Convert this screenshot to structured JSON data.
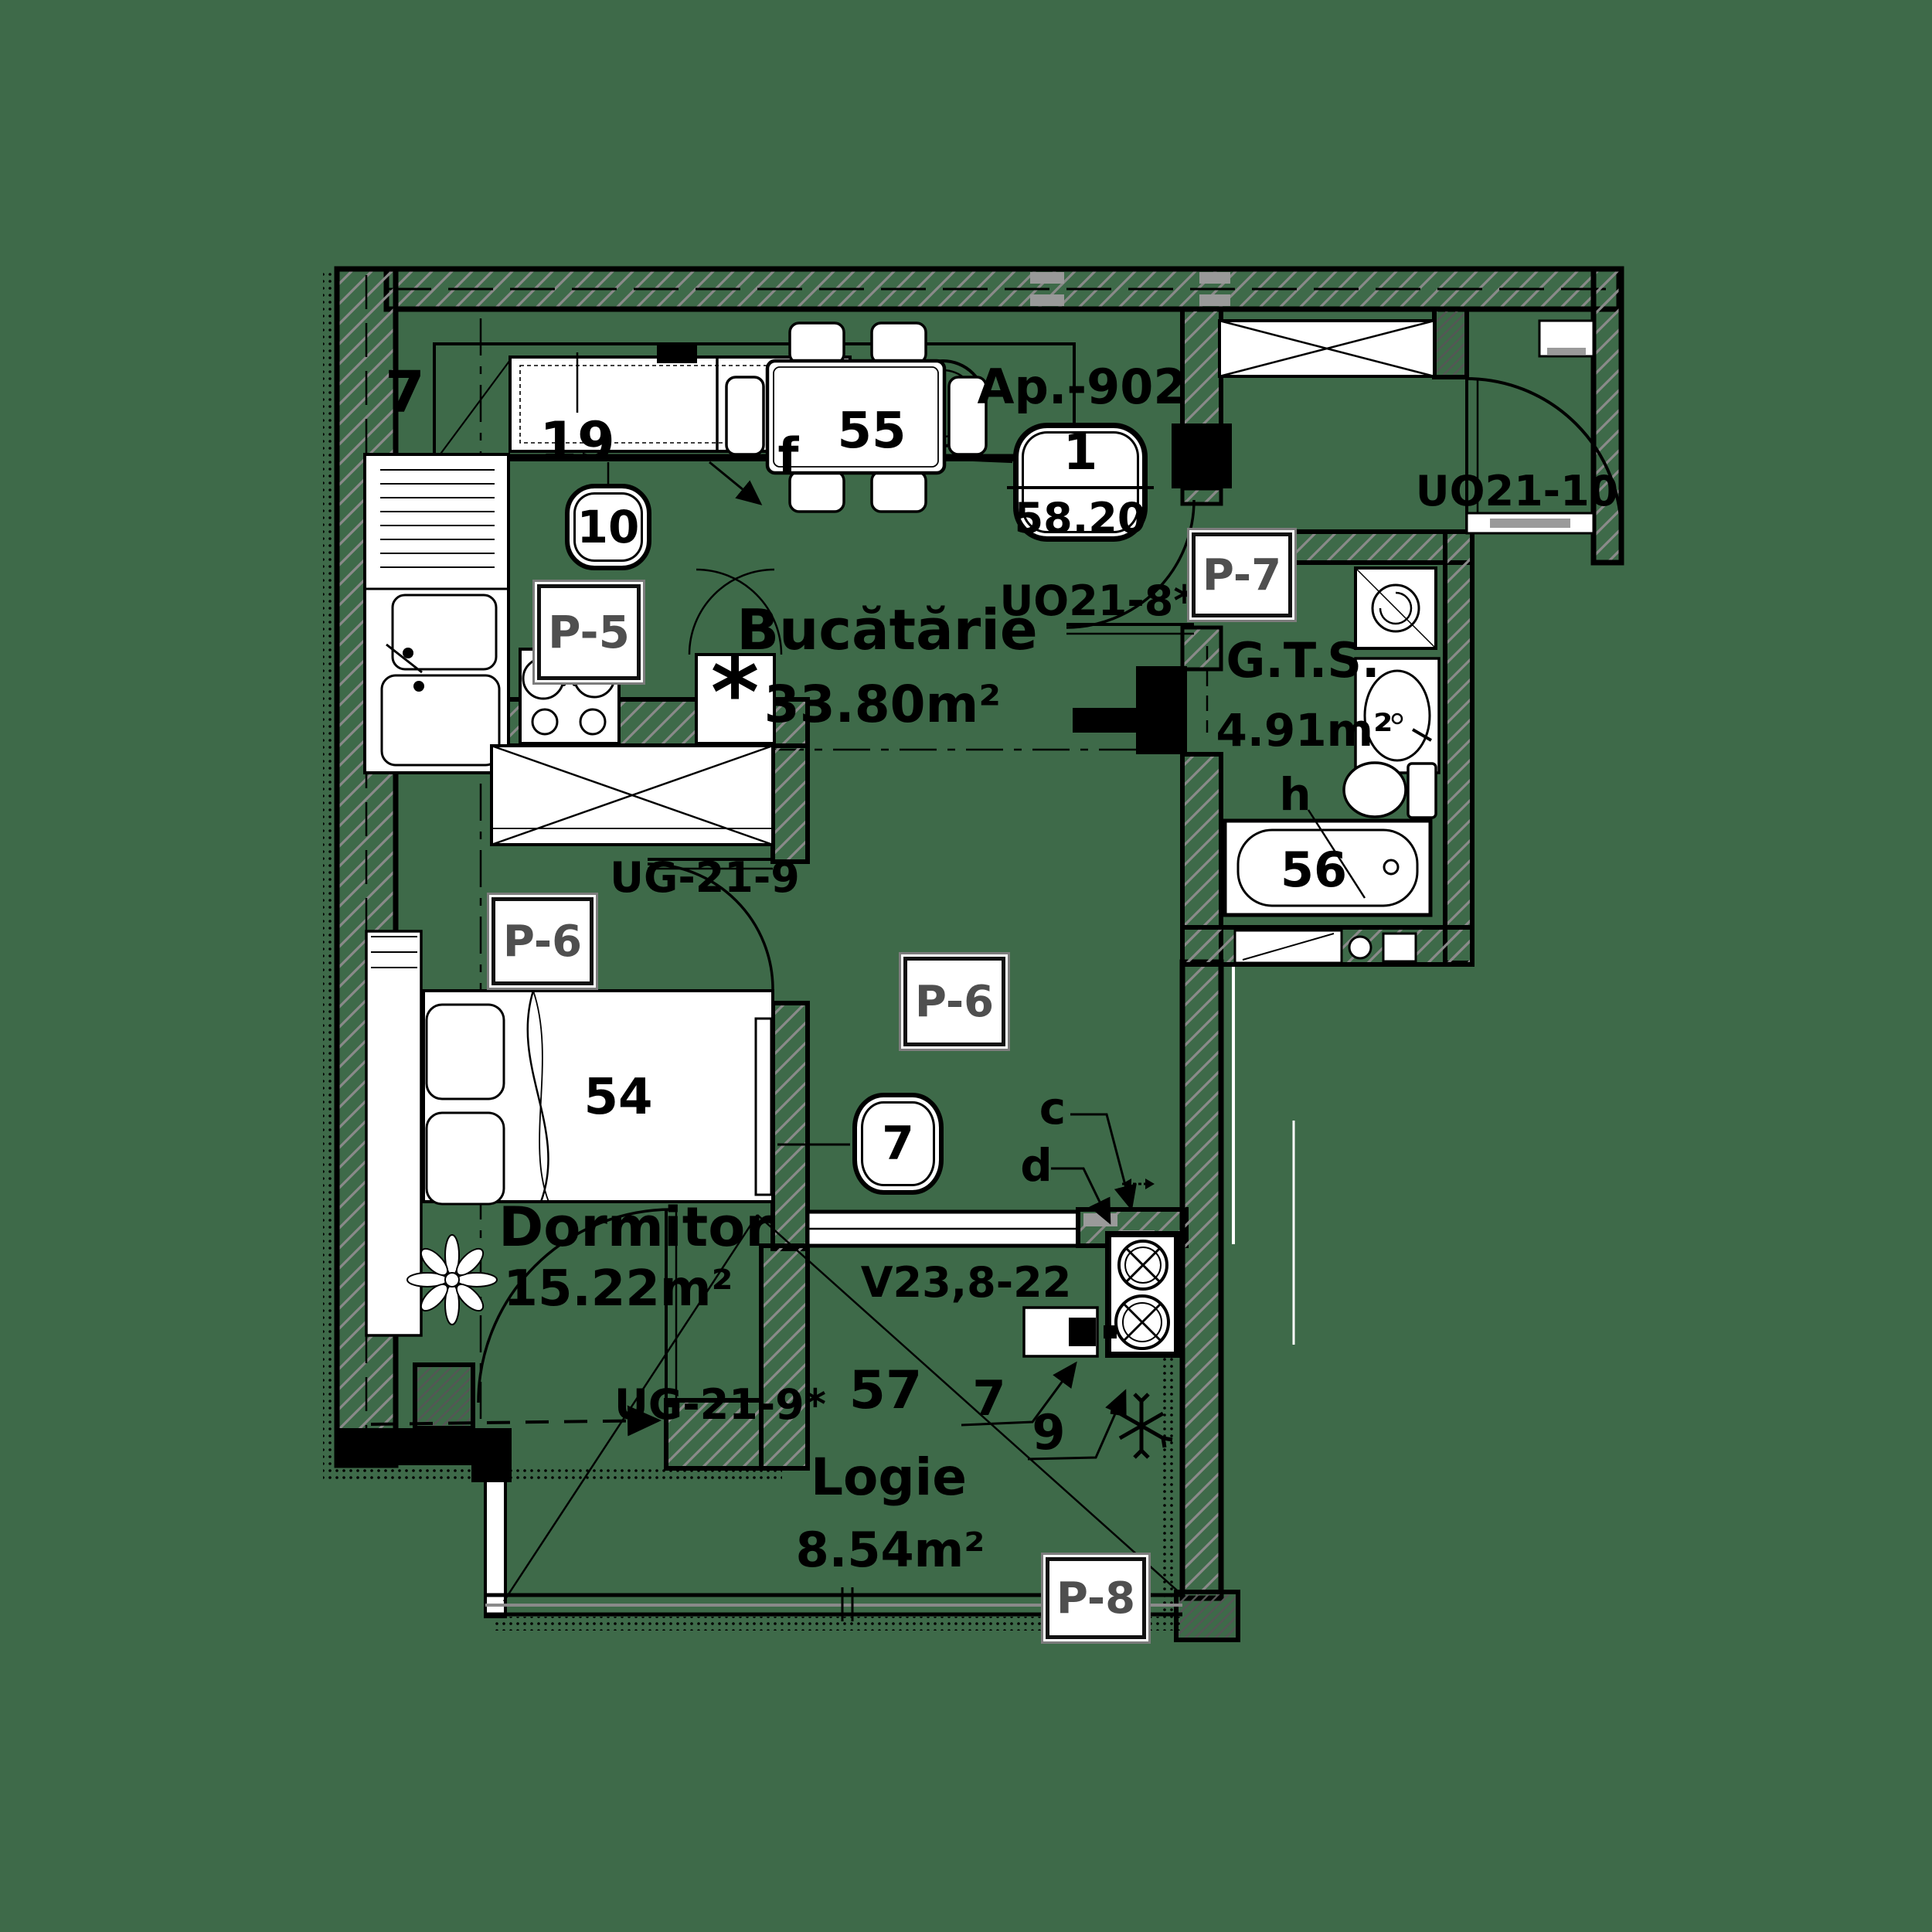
{
  "colors": {
    "background": "#3E6A49",
    "ink": "#000000",
    "paper": "#FFFFFF",
    "wall_hatch": "#8A8A8A",
    "muted_text": "#4F4F4F",
    "sill_gray": "#9A9A9A"
  },
  "apartment": {
    "label": "Ap.-902",
    "badge": {
      "rooms": "1",
      "area": "58.20"
    }
  },
  "rooms": {
    "kitchen": {
      "name": "Bucătărie",
      "area": "33.80m²",
      "finish": "P-5"
    },
    "bedroom": {
      "name": "Dormitor",
      "area": "15.22m²",
      "finish": "P-6"
    },
    "hall": {
      "finish": "P-6"
    },
    "bathroom": {
      "name": "G.T.S.",
      "area": "4.91m²",
      "finish": "P-7"
    },
    "loggia": {
      "name": "Logie",
      "area": "8.54m²",
      "finish": "P-8"
    }
  },
  "doors": {
    "entry": "UO21-10",
    "bathroom": "UO21-8*",
    "bedroom": "UG-21-9",
    "loggia_bedroom": "UG-21-9*"
  },
  "windows": {
    "loggia": "V23,8-22"
  },
  "callouts": {
    "axis_left": "7",
    "kitchen_hood": "19",
    "kitchen_circle": "10",
    "dining_table": "55",
    "dining_table_tag": "f",
    "bed": "54",
    "bathtub": "56",
    "bathtub_tag": "h",
    "loggia_number": "57",
    "hall_circle": "7",
    "loggia_tag_7": "7",
    "loggia_tag_9": "9",
    "vent_c": "c",
    "vent_d": "d"
  },
  "symbols": {
    "fridge_mark": "*"
  }
}
